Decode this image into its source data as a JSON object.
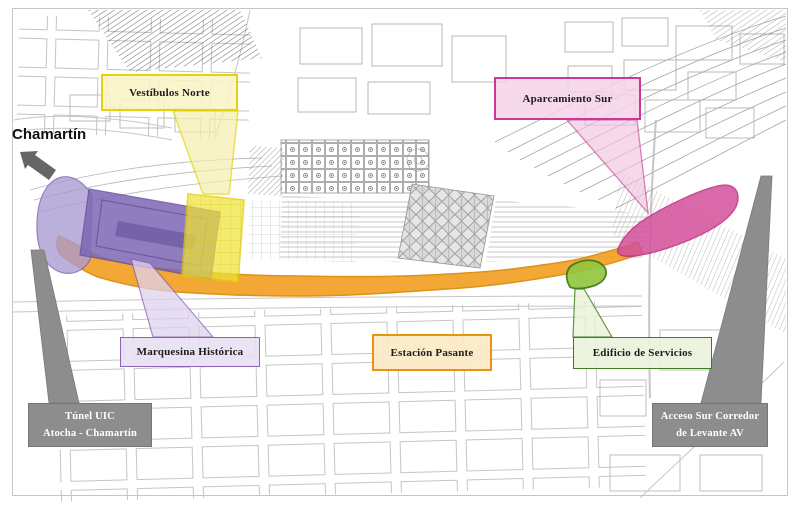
{
  "map": {
    "direction_label": "Chamartín",
    "zones": [
      {
        "name": "vestibulos-norte",
        "label": "Vestíbulos Norte",
        "color": "#e5d30a"
      },
      {
        "name": "marquesina-historica",
        "label": "Marquesina Histórica",
        "color": "#8a63b4"
      },
      {
        "name": "estacion-pasante",
        "label": "Estación Pasante",
        "color": "#e8940f"
      },
      {
        "name": "aparcamiento-sur",
        "label": "Aparcamiento Sur",
        "color": "#c73a96"
      },
      {
        "name": "edificio-de-servicios",
        "label": "Edificio de Servicios",
        "color": "#3f7d1c"
      }
    ],
    "callouts": [
      {
        "name": "tunel-uic",
        "line1": "Túnel UIC",
        "line2": "Atocha - Chamartín",
        "color": "#8d8d8d"
      },
      {
        "name": "acceso-sur-corredor",
        "line1": "Acceso Sur Corredor",
        "line2": "de Levante AV",
        "color": "#8d8d8d"
      }
    ]
  }
}
